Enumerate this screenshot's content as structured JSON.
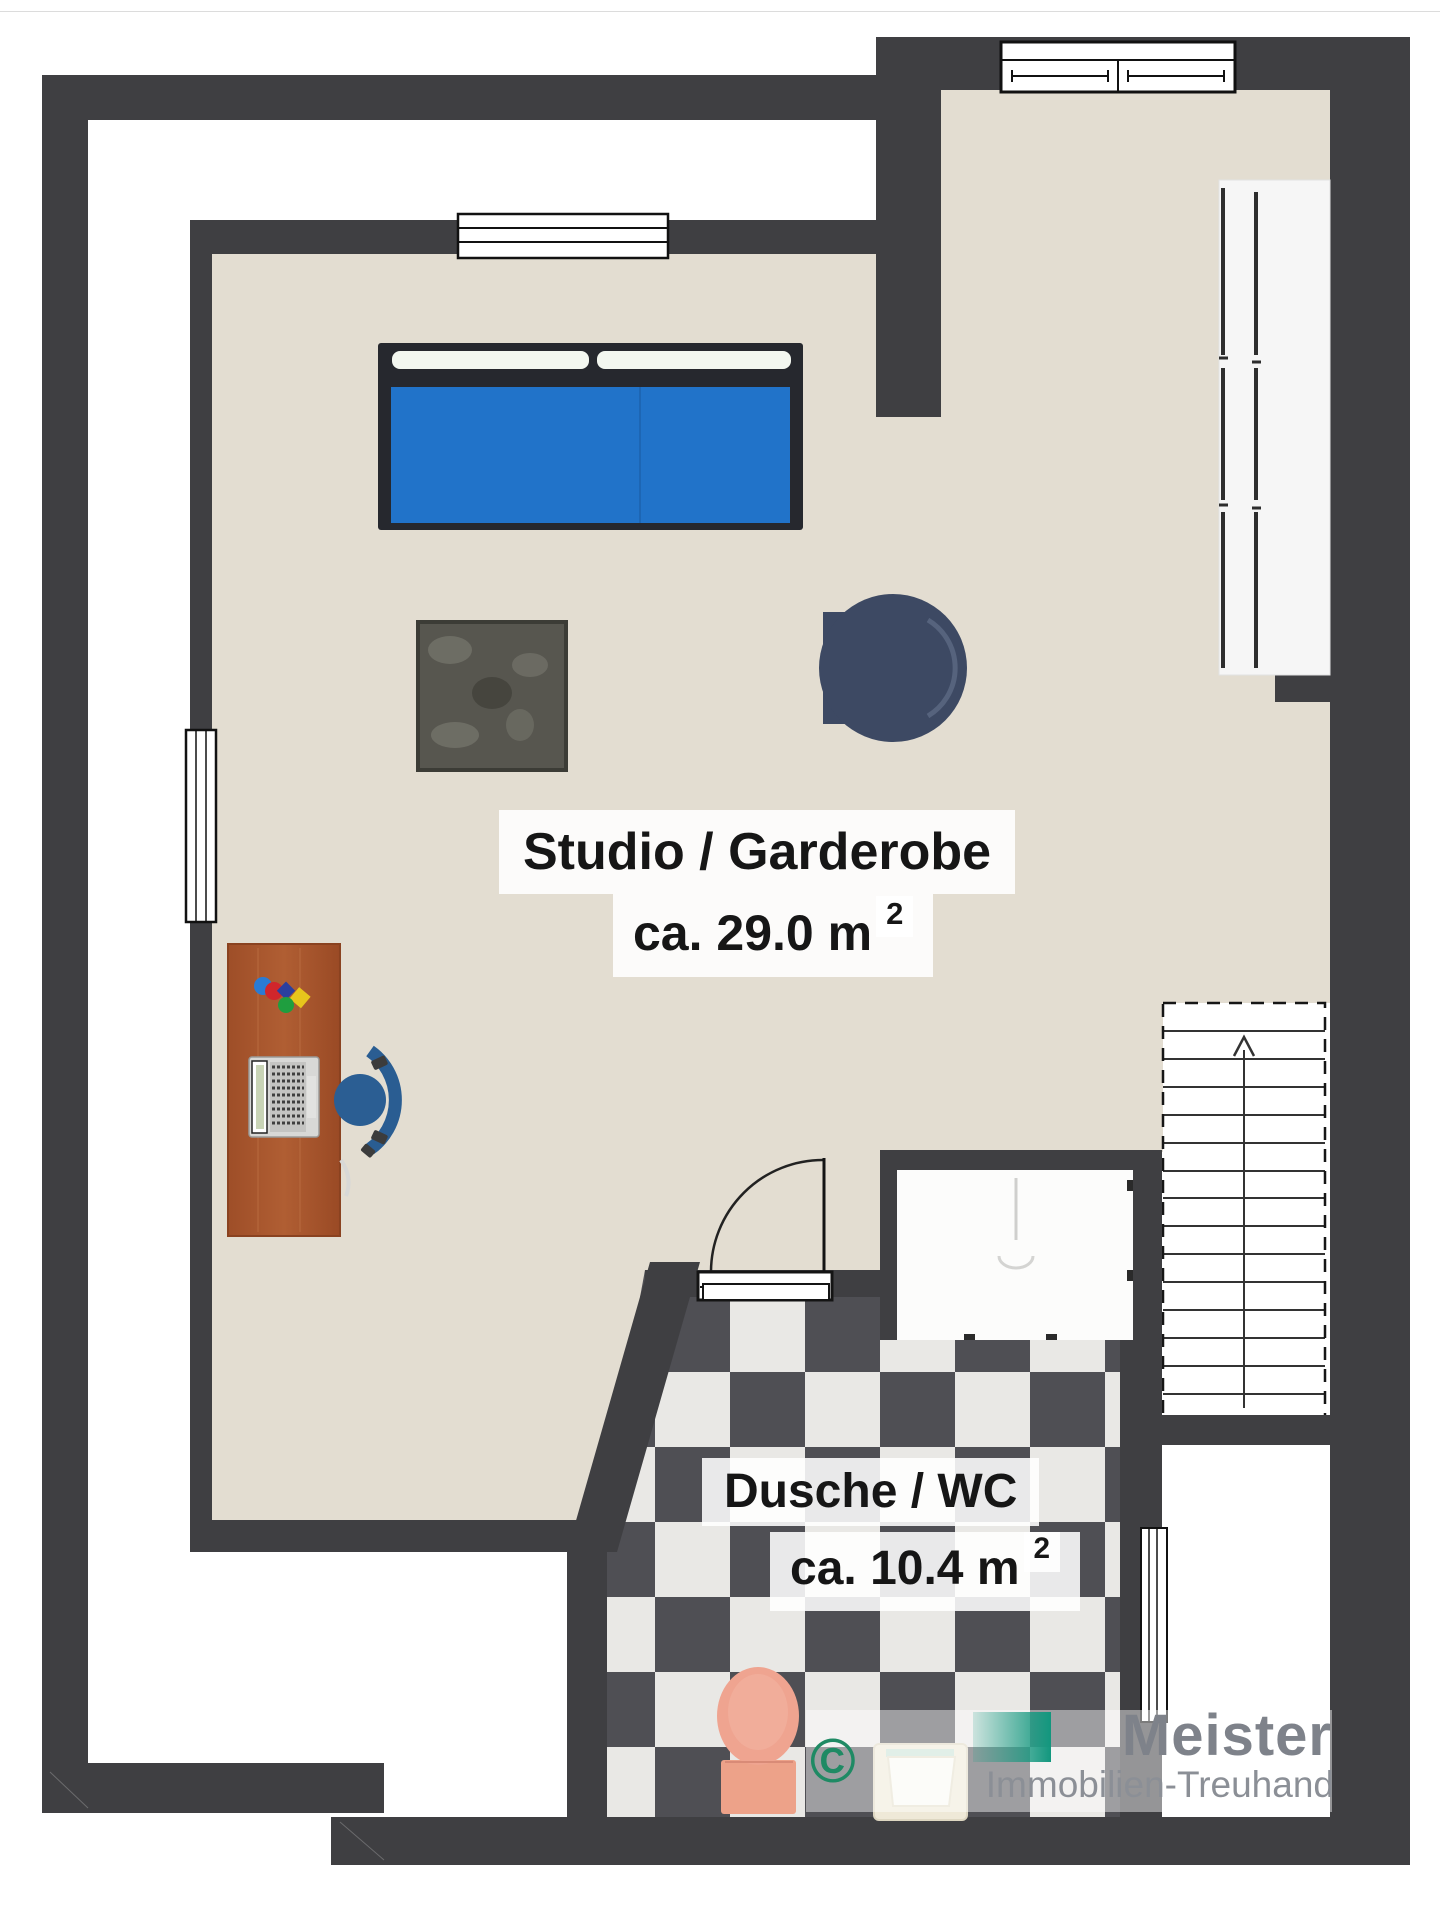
{
  "document": {
    "kind": "real-estate floor plan",
    "elements": [
      "double-bed",
      "rug",
      "lounge-chair",
      "desk",
      "laptop",
      "office-chair",
      "wardrobe",
      "staircase",
      "shower",
      "toilet",
      "sink",
      "door",
      "windows"
    ]
  },
  "rooms": [
    {
      "name": "Studio / Garderobe",
      "area": "ca. 29.0 m",
      "area_exponent": "2"
    },
    {
      "name": "Dusche / WC",
      "area": "ca. 10.4 m",
      "area_exponent": "2"
    }
  ],
  "stairs": {
    "arrow_direction": "up"
  },
  "watermark": {
    "copyright_symbol": "©",
    "brand": "Meister",
    "brand_subtitle": "Immobilien-Treuhand"
  },
  "colors": {
    "wall": "#3f3f42",
    "floor_beige": "#e3ddd1",
    "tile_dark": "#4f4f54",
    "tile_light": "#e9e8e5",
    "bed_blanket": "#2173c9",
    "bed_frame": "#26282e",
    "lounge_chair": "#3d4963",
    "desk_wood": "#a7532b",
    "office_chair": "#2b5e93",
    "toilet": "#efa490",
    "watermark_teal": "#12977e",
    "copyright_green": "#1f8a64",
    "brand_gray": "#7e828a"
  }
}
